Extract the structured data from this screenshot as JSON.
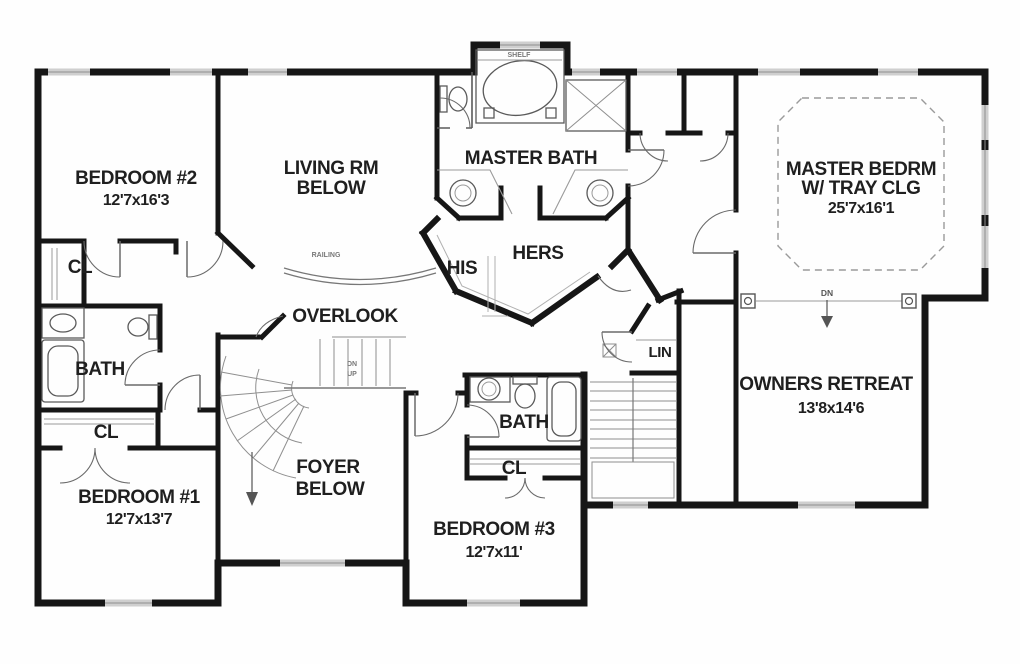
{
  "plan": {
    "bedroom2": {
      "name": "BEDROOM #2",
      "dims": "12'7x16'3"
    },
    "living_room": {
      "line1": "LIVING RM",
      "line2": "BELOW"
    },
    "master_bath": {
      "name": "MASTER BATH"
    },
    "his_closet": {
      "name": "HIS"
    },
    "hers_closet": {
      "name": "HERS"
    },
    "overlook": {
      "name": "OVERLOOK"
    },
    "master_bedroom": {
      "name": "MASTER BEDRM",
      "line2": "W/ TRAY CLG",
      "dims": "25'7x16'1"
    },
    "owners_retreat": {
      "name": "OWNERS RETREAT",
      "dims": "13'8x14'6"
    },
    "hall_bath": {
      "name": "BATH"
    },
    "bedroom1": {
      "name": "BEDROOM #1",
      "dims": "12'7x13'7"
    },
    "foyer": {
      "line1": "FOYER",
      "line2": "BELOW"
    },
    "bedroom3_bath": {
      "name": "BATH"
    },
    "bedroom3": {
      "name": "BEDROOM #3",
      "dims": "12'7x11'"
    },
    "closet_bedroom2": {
      "name": "CL"
    },
    "closet_bedroom1": {
      "name": "CL"
    },
    "closet_bedroom3": {
      "name": "CL"
    },
    "linen_closet": {
      "name": "LIN"
    }
  },
  "annotations": {
    "railing": "RAILING",
    "shelf": "SHELF",
    "stair_down": "DN",
    "stair_up": "UP",
    "step_down": "DN"
  },
  "colors": {
    "wall": "#161616",
    "window": "#cfcfcf",
    "fixture": "#5a5a5a",
    "faint": "#8f8f8f",
    "text": "#1f1f1f"
  }
}
